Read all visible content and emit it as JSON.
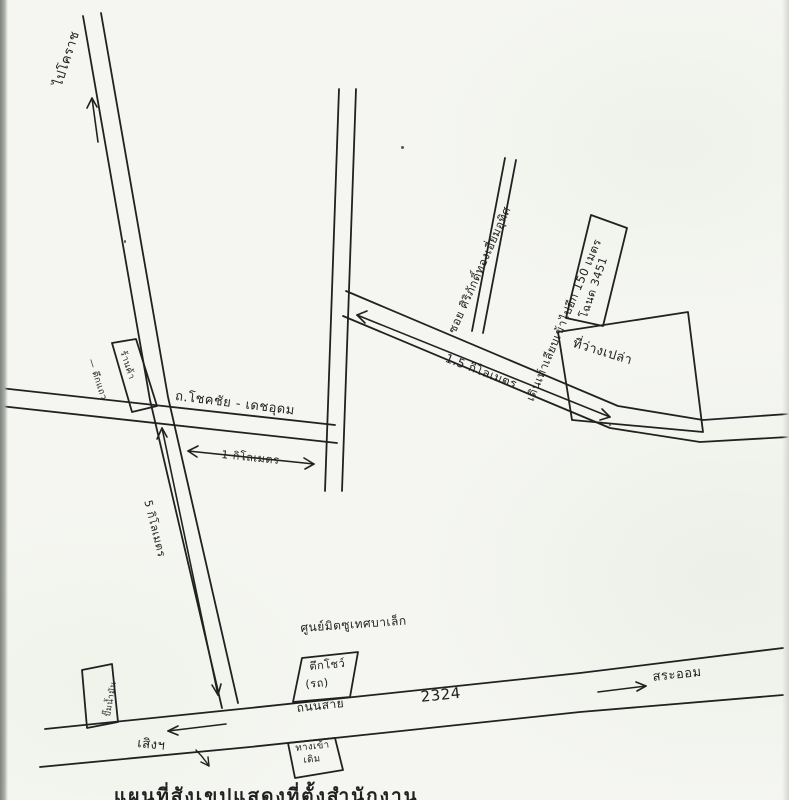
{
  "map": {
    "colors": {
      "ink": "#212121",
      "paper": "#f5f6f2"
    },
    "roads": {
      "north_road": {
        "label": "ไปโคราช"
      },
      "main_road": {
        "label": "ถ.โชคชัย - เดชอุดม"
      },
      "soi": {
        "label": "ซอย ศิริภักดิ์ทองเอี่ยมอุทิศ"
      },
      "highway": {
        "name": "ถนนสาย",
        "number": "2324"
      }
    },
    "distances": {
      "one_km": "1 กิโลเมตร",
      "one_point_five_km": "1.5 กิโลเมตร",
      "five_km": "5 กิโลเมตร",
      "walk_150m": "เดินเท้าเลียบเข้าไปอีก 150 เมตร"
    },
    "places": {
      "deed": "โฉนด 3451",
      "empty_land": "ที่ว่างเปล่า",
      "row_building": "— ตึกแถว",
      "shop": "ร้านค้า",
      "gas_station": "ปั๊มน้ำมัน",
      "dealer_center": "ศูนย์มิตซูเทศบาเล็ก",
      "showroom_line1": "ตึกโชว์",
      "showroom_line2": "(รถ)",
      "old_entrance_line1": "ทางเข้า",
      "old_entrance_line2": "เดิม"
    },
    "directions": {
      "west": "เสิงฯ",
      "east": "สระออม"
    },
    "footer": "แผนที่สังเขปแสดงที่ตั้งสำนักงาน"
  }
}
